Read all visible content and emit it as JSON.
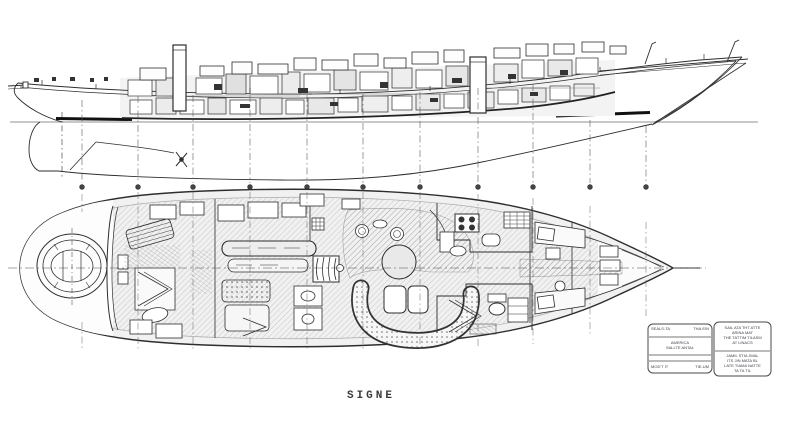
{
  "page": {
    "background_color": "#ffffff",
    "ink_color": "#2e2e2e",
    "paper_texture": "scanned blueprint, grayscale"
  },
  "drawing": {
    "vessel_name": "SIGNE",
    "views": [
      "inboard-profile",
      "arrangement-plan"
    ]
  },
  "title_block": {
    "left_box": {
      "row1_left": "SEALS-TA",
      "row1_right": "THA.EIN",
      "row2_line1": "AMERICA",
      "row2_line2": "SALLTE ANTAL",
      "row3_left": "MOD'T IT",
      "row3_right": "TIE-UM"
    },
    "right_box": {
      "upper_lines": [
        "SAIL ATA THT ATTE",
        "ARINA MAT",
        "THE TATTIM TILASM",
        "AT LINACS"
      ],
      "lower_lines": [
        "JAMIL STIA JMAL",
        "ITS JIN MATA BL",
        "LATE TIAMA NATTE",
        "TA TA TIL"
      ]
    }
  }
}
